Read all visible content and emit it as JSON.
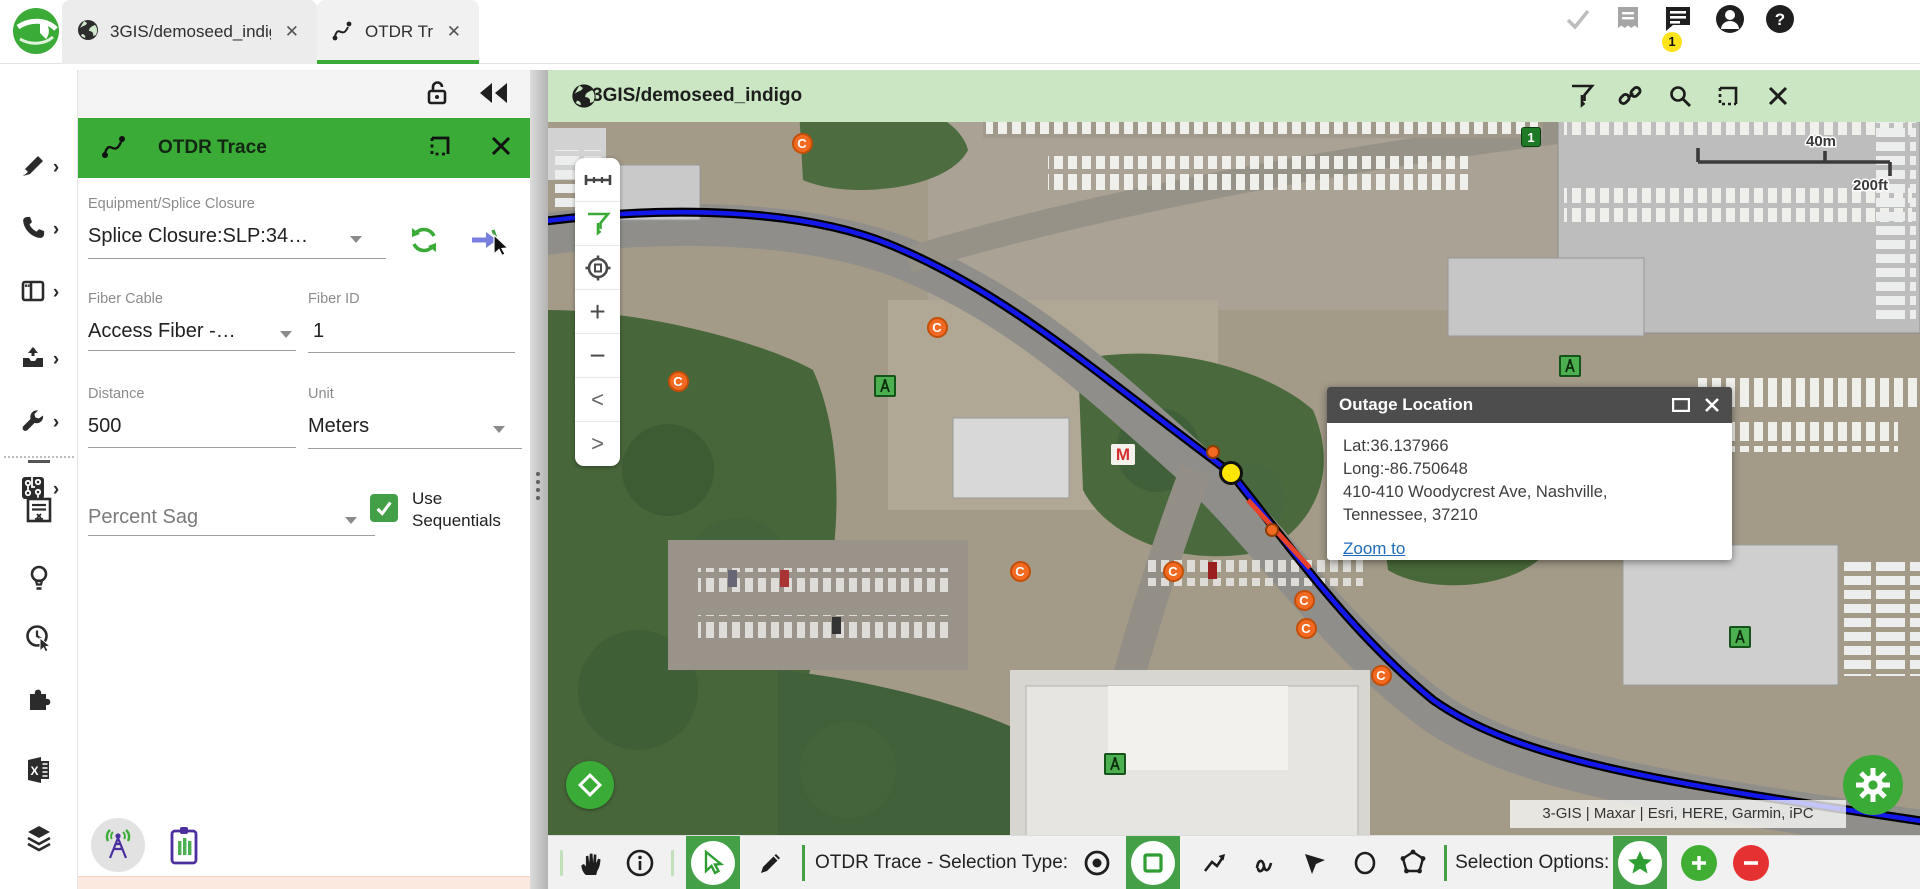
{
  "window": {
    "tabs": [
      {
        "label": "3GIS/demoseed_indigo"
      },
      {
        "label": "OTDR Trace"
      }
    ],
    "notification_badge": "1"
  },
  "panel": {
    "title": "OTDR Trace",
    "equipment": {
      "label": "Equipment/Splice Closure",
      "value": "Splice Closure:SLP:34…"
    },
    "fiber_cable": {
      "label": "Fiber Cable",
      "value": "Access Fiber -…"
    },
    "fiber_id": {
      "label": "Fiber ID",
      "value": "1"
    },
    "distance": {
      "label": "Distance",
      "value": "500"
    },
    "unit": {
      "label": "Unit",
      "value": "Meters"
    },
    "sag": {
      "placeholder": "Percent Sag"
    },
    "use_sequentials": {
      "line1": "Use",
      "line2": "Sequentials",
      "checked": true
    }
  },
  "map": {
    "title": "3GIS/demoseed_indigo",
    "scale": {
      "metric": "40m",
      "imperial": "200ft"
    },
    "attribution": "3-GIS | Maxar | Esri, HERE, Garmin, iPC",
    "popup": {
      "title": "Outage Location",
      "lat": "Lat:36.137966",
      "long": "Long:-86.750648",
      "address_line1": "410-410 Woodycrest Ave, Nashville,",
      "address_line2": "Tennessee, 37210",
      "link": "Zoom to"
    },
    "toolbar": {
      "selection_type_label": "OTDR Trace - Selection Type:",
      "selection_options_label": "Selection Options:"
    },
    "markers": {
      "closure_label": "C",
      "closures": [
        [
          254,
          73
        ],
        [
          389,
          257
        ],
        [
          130,
          311
        ],
        [
          472,
          501
        ],
        [
          625,
          501
        ],
        [
          756,
          530
        ],
        [
          758,
          558
        ],
        [
          833,
          605
        ]
      ],
      "dots": [
        [
          665,
          382
        ],
        [
          724,
          460
        ]
      ],
      "devices": [
        [
          337,
          316
        ],
        [
          1022,
          296
        ],
        [
          567,
          694
        ],
        [
          1192,
          567
        ]
      ],
      "m_label": "M",
      "m_point": [
        575,
        384
      ],
      "selected_point": [
        683,
        403
      ],
      "count_label": "1",
      "count_point": [
        983,
        67
      ]
    }
  },
  "colors": {
    "accent_green": "#3aab36",
    "map_header_green": "#cbe6c3",
    "tool_green": "#43a047",
    "fiber_blue": "#1317e8",
    "marker_orange": "#f26a21",
    "selected_yellow": "#ffe600",
    "alert_red": "#e53131"
  }
}
